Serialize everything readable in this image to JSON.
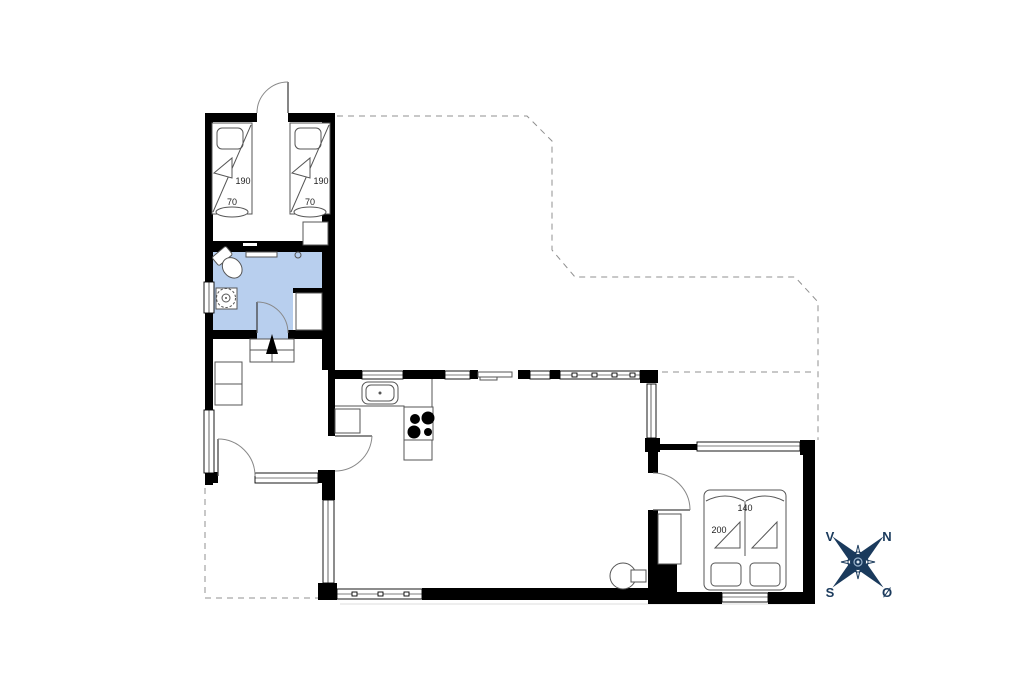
{
  "plan": {
    "beds": {
      "single_bed_1": {
        "length": "190",
        "width": "70"
      },
      "single_bed_2": {
        "length": "190",
        "width": "70"
      },
      "double_bed": {
        "width": "140",
        "length": "200"
      }
    },
    "compass": {
      "west": "V",
      "north": "N",
      "south": "S",
      "east": "Ø"
    },
    "colors": {
      "wall": "#000000",
      "bathroom_fill": "#b8cfee",
      "compass": "#1a3a5c",
      "dashed_line": "#909090"
    }
  }
}
